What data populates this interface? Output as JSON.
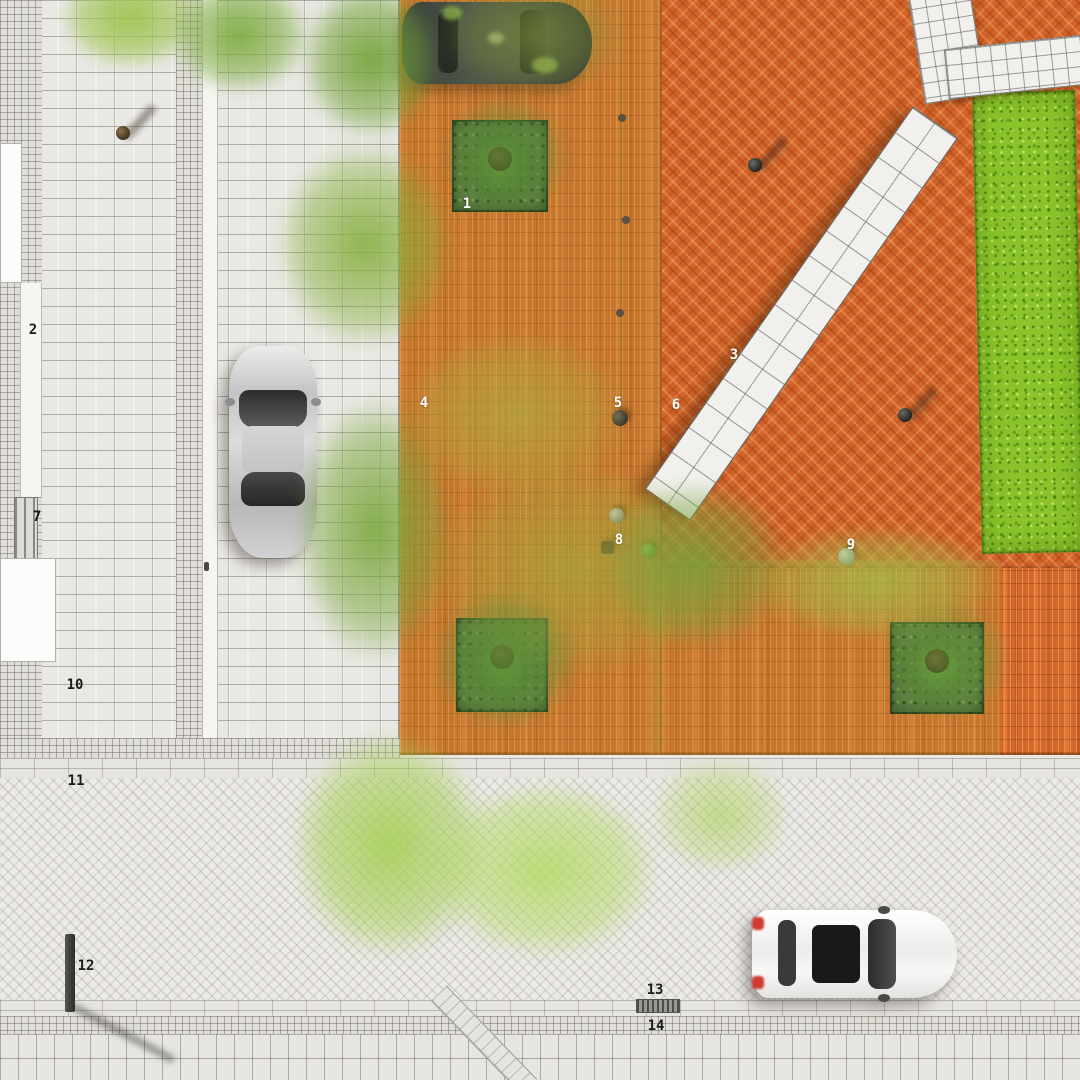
{
  "meta": {
    "type": "architectural-site-plan",
    "view": "top-down-rendered-masterplan"
  },
  "colors": {
    "plaza_brick": "#d4682a",
    "plaza_brick_light": "#e8915a",
    "plaza_brick_dark": "#b04e1a",
    "sidewalk": "#e9e8e4",
    "street": "#eceae7",
    "lawn": "#8cc32a",
    "planting_bed": "#5f8046",
    "tree_olive": "#b0a83e",
    "tree_green": "#74a23a",
    "tree_light": "#aed25c",
    "bench_white": "#f1f0ed",
    "car_silver": "#c7c7c7",
    "car_dark": "#434a40",
    "car_white": "#f3f3f1",
    "taillight_red": "#d03a30",
    "label_light": "#ffffff",
    "label_dark": "#1a1a1a"
  },
  "markers": [
    {
      "label": "1",
      "tone": "light"
    },
    {
      "label": "2",
      "tone": "dark"
    },
    {
      "label": "3",
      "tone": "light"
    },
    {
      "label": "4",
      "tone": "light"
    },
    {
      "label": "5",
      "tone": "light"
    },
    {
      "label": "6",
      "tone": "light"
    },
    {
      "label": "7",
      "tone": "dark"
    },
    {
      "label": "8",
      "tone": "light"
    },
    {
      "label": "9",
      "tone": "light"
    },
    {
      "label": "10",
      "tone": "dark"
    },
    {
      "label": "11",
      "tone": "dark"
    },
    {
      "label": "12",
      "tone": "dark"
    },
    {
      "label": "13",
      "tone": "dark"
    },
    {
      "label": "14",
      "tone": "dark"
    }
  ]
}
